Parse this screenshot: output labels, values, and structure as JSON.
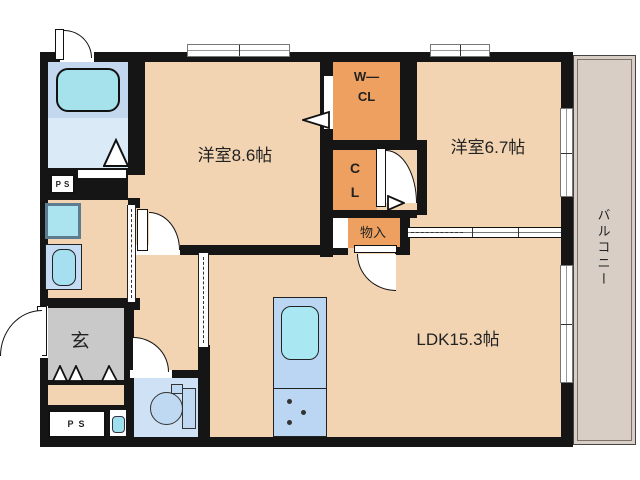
{
  "labels": {
    "room_west_86": "洋室8.6帖",
    "room_west_67": "洋室6.7帖",
    "ldk": "LDK15.3帖",
    "walkin_closet_line1": "W―",
    "walkin_closet_line2": "CL",
    "closet_line1": "C",
    "closet_line2": "L",
    "storage": "物入",
    "entrance": "玄",
    "balcony": "バルコニー",
    "pipe_space_top": "PS",
    "pipe_space_bottom": "PS"
  },
  "colors": {
    "wall": "#151515",
    "floor": "#F2D4B3",
    "closet": "#EDA05F",
    "balcony": "#D8CEC5",
    "entrance_floor": "#C9C9C9",
    "bath_upper": "#C3D8EE",
    "bath_lower": "#DBEAF7",
    "bathtub": "#A5E2EC",
    "toilet_room": "#CEE1F5",
    "kitchen_counter": "#BAD6F2",
    "kitchen_sink": "#A9E8F2",
    "fixture_blue": "#BFD9F3"
  }
}
